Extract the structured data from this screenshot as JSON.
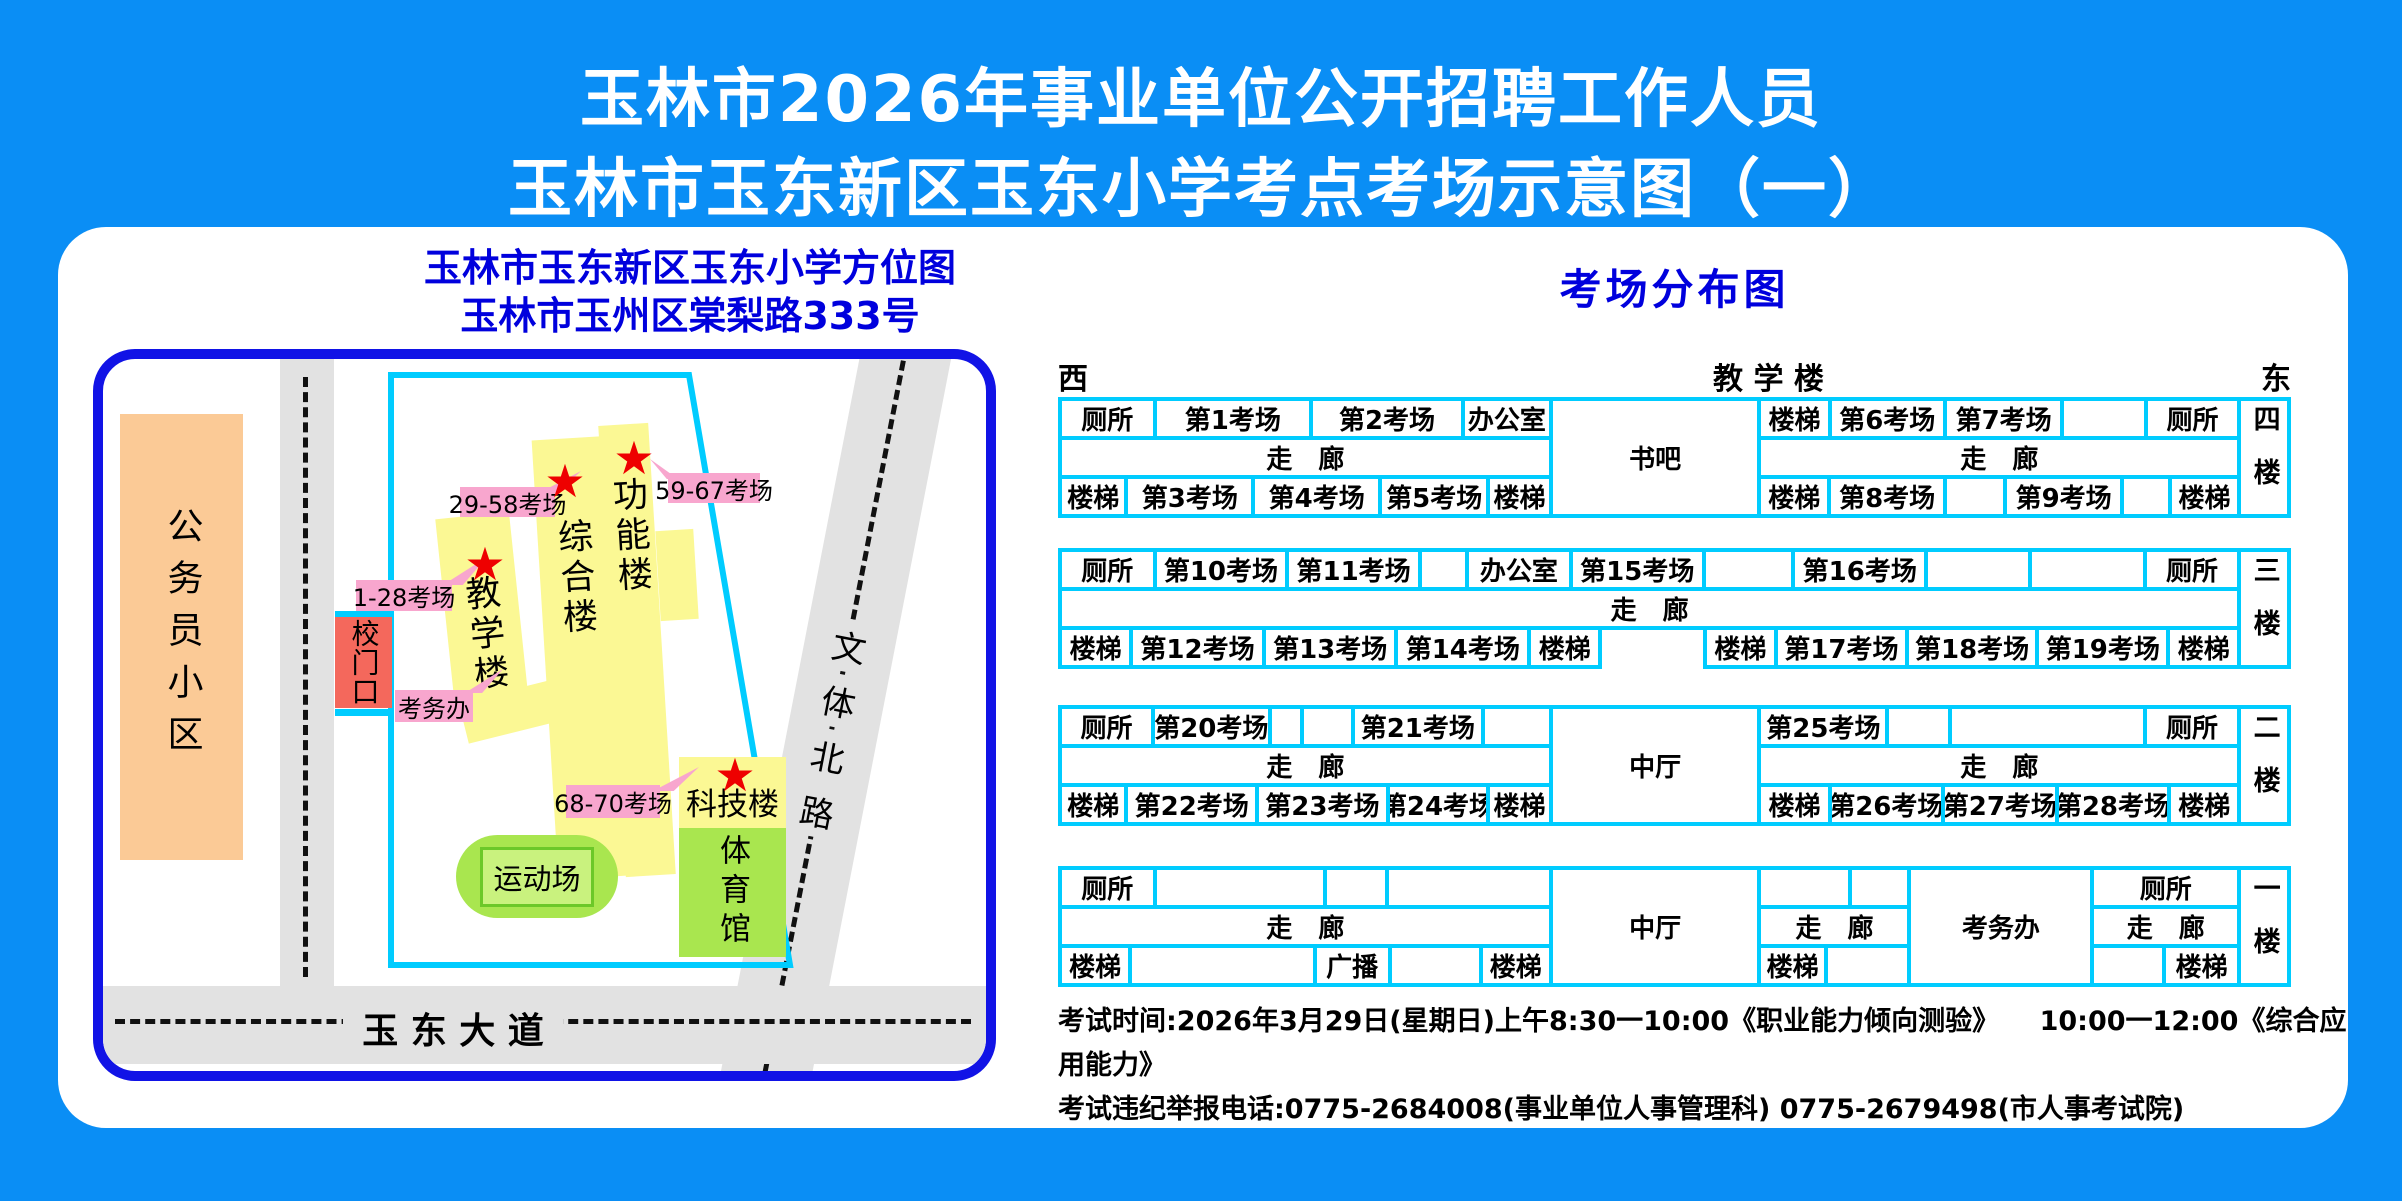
{
  "header": {
    "title_line1": "玉林市2026年事业单位公开招聘工作人员",
    "title_line2": "玉林市玉东新区玉东小学考点考场示意图（一）"
  },
  "map": {
    "title_line1": "玉林市玉东新区玉东小学方位图",
    "title_line2": "玉林市玉州区棠梨路333号",
    "community": "公务员小区",
    "gate": "校门口",
    "exam_office_label": "考务办",
    "playground": "运动场",
    "gym": "体育馆",
    "star_icon": "★",
    "buildings": {
      "teaching": {
        "name": "教学楼",
        "badge": "1-28考场"
      },
      "complex": {
        "name": "综合楼",
        "badge": "29-58考场"
      },
      "function": {
        "name": "功能楼",
        "badge": "59-67考场"
      },
      "science": {
        "name": "科技楼",
        "badge": "68-70考场"
      }
    },
    "roads": {
      "bottom": "玉 东 大 道",
      "diagonal": "文体北路"
    },
    "colors": {
      "building_yellow": "#FBF894",
      "building_green": "#A9E64F",
      "gate_red": "#F4685C",
      "community_orange": "#FBCA96",
      "label_pink": "#F8A6CE",
      "boundary_cyan": "#00CCFF",
      "map_border_blue": "#1113E6",
      "page_blue": "#0A8EF5",
      "title_blue": "#0000DD"
    }
  },
  "dist": {
    "title": "考场分布图",
    "west": "西",
    "east": "东",
    "building_header": "教 学 楼",
    "floors": [
      {
        "label": "四楼",
        "sections": [
          {
            "kind": "rows",
            "flex": 498,
            "rows": [
              {
                "cells": [
                  {
                    "t": "厕所",
                    "w": 95
                  },
                  {
                    "t": "第1考场",
                    "w": 160
                  },
                  {
                    "t": "第2考场",
                    "w": 155
                  },
                  {
                    "t": "办公室",
                    "w": 88
                  }
                ]
              },
              {
                "cells": [
                  {
                    "t": "走　廊",
                    "w": 498
                  }
                ]
              },
              {
                "cells": [
                  {
                    "t": "楼梯",
                    "w": 66
                  },
                  {
                    "t": "第3考场",
                    "w": 130
                  },
                  {
                    "t": "第4考场",
                    "w": 130
                  },
                  {
                    "t": "第5考场",
                    "w": 110
                  },
                  {
                    "t": "楼梯",
                    "w": 62
                  }
                ]
              }
            ]
          },
          {
            "kind": "span",
            "t": "书吧",
            "flex": 206
          },
          {
            "kind": "rows",
            "flex": 487,
            "rows": [
              {
                "cells": [
                  {
                    "t": "楼梯",
                    "w": 70
                  },
                  {
                    "t": "第6考场",
                    "w": 118
                  },
                  {
                    "t": "第7考场",
                    "w": 120
                  },
                  {
                    "t": "",
                    "w": 84
                  },
                  {
                    "t": "厕所",
                    "w": 95
                  }
                ]
              },
              {
                "cells": [
                  {
                    "t": "走　廊",
                    "w": 487
                  }
                ]
              },
              {
                "cells": [
                  {
                    "t": "楼梯",
                    "w": 70
                  },
                  {
                    "t": "第8考场",
                    "w": 120
                  },
                  {
                    "t": "",
                    "w": 60
                  },
                  {
                    "t": "第9考场",
                    "w": 120
                  },
                  {
                    "t": "",
                    "w": 47
                  },
                  {
                    "t": "楼梯",
                    "w": 70
                  }
                ]
              }
            ]
          },
          {
            "kind": "floor",
            "t": "四楼",
            "flex": 46
          }
        ]
      },
      {
        "label": "三楼",
        "sections": [
          {
            "kind": "rows",
            "flex": 1191,
            "rows": [
              {
                "cells": [
                  {
                    "t": "厕所",
                    "w": 95
                  },
                  {
                    "t": "第10考场",
                    "w": 135
                  },
                  {
                    "t": "第11考场",
                    "w": 135
                  },
                  {
                    "t": "",
                    "w": 45
                  },
                  {
                    "t": "办公室",
                    "w": 105
                  },
                  {
                    "t": "第15考场",
                    "w": 135
                  },
                  {
                    "t": "",
                    "w": 90
                  },
                  {
                    "t": "第16考场",
                    "w": 135
                  },
                  {
                    "t": "",
                    "w": 105
                  },
                  {
                    "t": "",
                    "w": 116
                  },
                  {
                    "t": "厕所",
                    "w": 95
                  }
                ]
              },
              {
                "cells": [
                  {
                    "t": "走　廊",
                    "w": 1191
                  }
                ]
              },
              {
                "cells": [
                  {
                    "t": "楼梯",
                    "w": 70
                  },
                  {
                    "t": "第12考场",
                    "w": 134
                  },
                  {
                    "t": "第13考场",
                    "w": 134
                  },
                  {
                    "t": "第14考场",
                    "w": 134
                  },
                  {
                    "t": "楼梯",
                    "w": 70
                  },
                  {
                    "t": "",
                    "w": 113,
                    "gap": true
                  },
                  {
                    "t": "楼梯",
                    "w": 70
                  },
                  {
                    "t": "第17考场",
                    "w": 132
                  },
                  {
                    "t": "第18考场",
                    "w": 132
                  },
                  {
                    "t": "第19考场",
                    "w": 132
                  },
                  {
                    "t": "楼梯",
                    "w": 70
                  }
                ]
              }
            ]
          },
          {
            "kind": "floor",
            "t": "三楼",
            "flex": 46
          }
        ]
      },
      {
        "label": "二楼",
        "sections": [
          {
            "kind": "rows",
            "flex": 498,
            "rows": [
              {
                "cells": [
                  {
                    "t": "厕所",
                    "w": 95
                  },
                  {
                    "t": "第20考场",
                    "w": 120
                  },
                  {
                    "t": "",
                    "w": 30
                  },
                  {
                    "t": "",
                    "w": 50
                  },
                  {
                    "t": "第21考场",
                    "w": 135
                  },
                  {
                    "t": "",
                    "w": 68
                  }
                ]
              },
              {
                "cells": [
                  {
                    "t": "走　廊",
                    "w": 498
                  }
                ]
              },
              {
                "cells": [
                  {
                    "t": "楼梯",
                    "w": 66
                  },
                  {
                    "t": "第22考场",
                    "w": 134
                  },
                  {
                    "t": "第23考场",
                    "w": 134
                  },
                  {
                    "t": "第24考场",
                    "w": 102
                  },
                  {
                    "t": "楼梯",
                    "w": 62
                  }
                ]
              }
            ]
          },
          {
            "kind": "span",
            "t": "中厅",
            "flex": 206
          },
          {
            "kind": "rows",
            "flex": 487,
            "rows": [
              {
                "cells": [
                  {
                    "t": "第25考场",
                    "w": 130
                  },
                  {
                    "t": "",
                    "w": 62
                  },
                  {
                    "t": "",
                    "w": 200
                  },
                  {
                    "t": "厕所",
                    "w": 95
                  }
                ]
              },
              {
                "cells": [
                  {
                    "t": "走　廊",
                    "w": 487
                  }
                ]
              },
              {
                "cells": [
                  {
                    "t": "楼梯",
                    "w": 70
                  },
                  {
                    "t": "第26考场",
                    "w": 116
                  },
                  {
                    "t": "第27考场",
                    "w": 116
                  },
                  {
                    "t": "第28考场",
                    "w": 115
                  },
                  {
                    "t": "楼梯",
                    "w": 70
                  }
                ]
              }
            ]
          },
          {
            "kind": "floor",
            "t": "二楼",
            "flex": 46
          }
        ]
      },
      {
        "label": "一楼",
        "sections": [
          {
            "kind": "rows",
            "flex": 498,
            "rows": [
              {
                "cells": [
                  {
                    "t": "厕所",
                    "w": 95
                  },
                  {
                    "t": "",
                    "w": 175
                  },
                  {
                    "t": "",
                    "w": 60
                  },
                  {
                    "t": "",
                    "w": 168
                  }
                ]
              },
              {
                "cells": [
                  {
                    "t": "走　廊",
                    "w": 498
                  }
                ]
              },
              {
                "cells": [
                  {
                    "t": "楼梯",
                    "w": 70
                  },
                  {
                    "t": "",
                    "w": 191
                  },
                  {
                    "t": "广播",
                    "w": 75
                  },
                  {
                    "t": "",
                    "w": 92
                  },
                  {
                    "t": "楼梯",
                    "w": 70
                  }
                ]
              }
            ]
          },
          {
            "kind": "span",
            "t": "中厅",
            "flex": 206
          },
          {
            "kind": "rows",
            "flex": 155,
            "rows": [
              {
                "cells": [
                  {
                    "t": "",
                    "w": 94
                  },
                  {
                    "t": "",
                    "w": 61
                  }
                ]
              },
              {
                "cells": [
                  {
                    "t": "走　廊",
                    "w": 155
                  }
                ]
              },
              {
                "cells": [
                  {
                    "t": "楼梯",
                    "w": 68
                  },
                  {
                    "t": "",
                    "w": 87
                  }
                ]
              }
            ]
          },
          {
            "kind": "span",
            "t": "考务办",
            "flex": 180
          },
          {
            "kind": "rows",
            "flex": 152,
            "rows": [
              {
                "cells": [
                  {
                    "t": "厕所",
                    "w": 152
                  }
                ]
              },
              {
                "cells": [
                  {
                    "t": "走　廊",
                    "w": 152
                  }
                ]
              },
              {
                "cells": [
                  {
                    "t": "",
                    "w": 74
                  },
                  {
                    "t": "楼梯",
                    "w": 78
                  }
                ]
              }
            ]
          },
          {
            "kind": "floor",
            "t": "一楼",
            "flex": 46
          }
        ]
      }
    ]
  },
  "footer": {
    "line1": "考试时间:2026年3月29日(星期日)上午8:30一10:00《职业能力倾向测验》　　10:00一12:00《综合应用能力》",
    "line2": "考试违纪举报电话:0775-2684008(事业单位人事管理科)  0775-2679498(市人事考试院)"
  }
}
